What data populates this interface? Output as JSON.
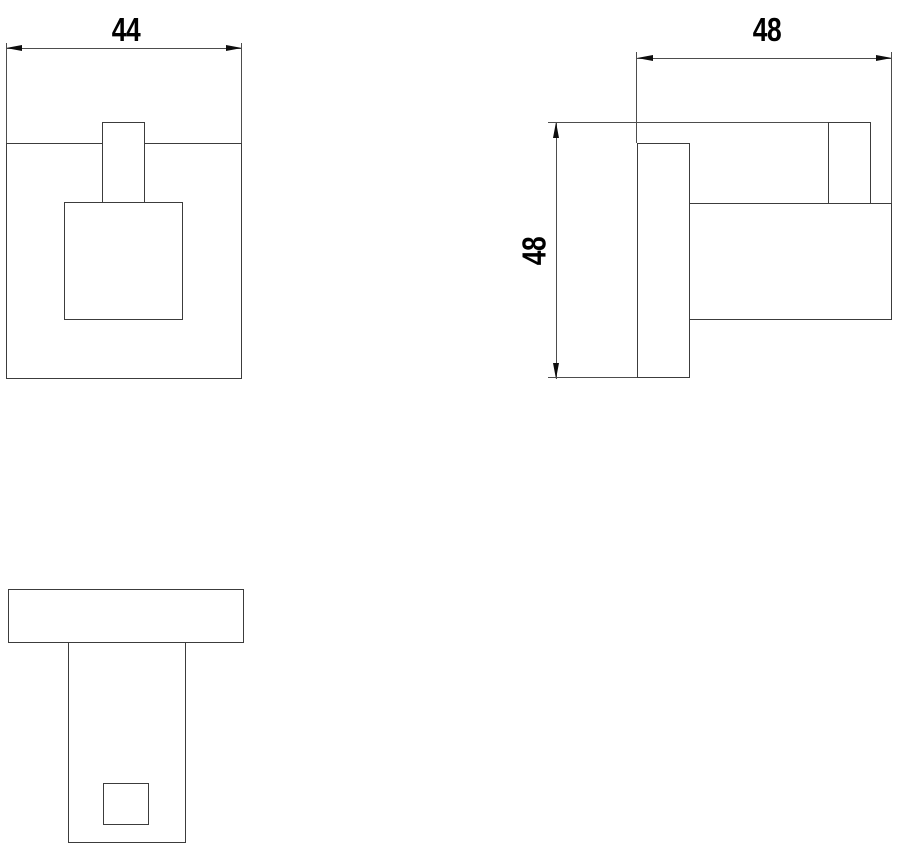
{
  "drawing": {
    "views": {
      "front": {
        "width_dim": {
          "label": "44"
        }
      },
      "side": {
        "depth_dim": {
          "label": "48"
        },
        "height_dim": {
          "label": "48"
        }
      },
      "bottom": {}
    },
    "colors": {
      "background": "#ffffff",
      "object_line": "#3c3c3c",
      "dimension_line": "#4d4d4d",
      "arrow": "#0d0d0d",
      "text": "#000000"
    }
  }
}
